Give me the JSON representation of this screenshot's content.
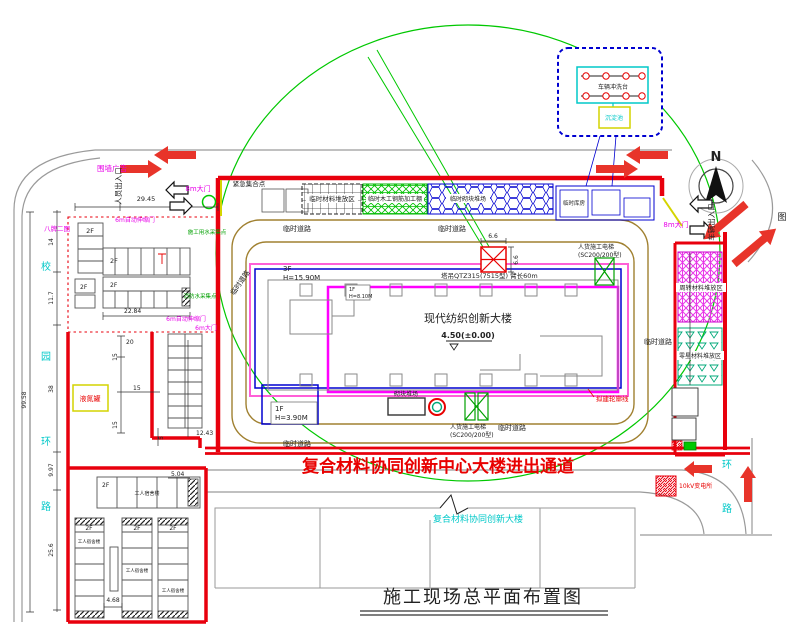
{
  "title": "施工现场总平面布置图",
  "passage_text": "复合材料协同创新中心大楼进出通道",
  "existing_building": "复合材料协同创新大楼",
  "compass": {
    "north": "N"
  },
  "legend_char": "图",
  "building": {
    "name": "现代纺织创新大楼",
    "elevation": "4.50(±0.00)",
    "f3": "3F",
    "h3": "H=15.90M",
    "f1": "1F",
    "h1": "H=3.90M",
    "fa": "1F",
    "ha": "H=8.10M",
    "f2": "2F"
  },
  "equipment": {
    "tower_crane": "塔吊QTZ315(7515型) 臂长60m",
    "hoist_line1": "人货施工电梯",
    "hoist_line2": "(SC200/200型)"
  },
  "gates": {
    "gate8m": "8m大门",
    "gate6m": "6m大门",
    "auto_gate": "6m自动伸缩门",
    "people_entrance": "人员出入口",
    "vehicle_entrance": "车辆出入口"
  },
  "facilities": {
    "fence_ad": "围墙广告",
    "eight_boards": "八牌二图",
    "emergency": "紧急集合点",
    "water_collect": "施工用水采集点",
    "fire_water": "消防水采集点",
    "temp_road": "临时道路",
    "material_area": "临时材料堆放区",
    "wood_shed": "临时木工钢筋加工棚",
    "block_yard_top": "临时砌块堆场",
    "storehouse": "临时库房",
    "wash_platform": "车辆冲洗台",
    "sediment": "沉淀池",
    "turnover_area": "周转材料堆放区",
    "misc_area": "零星材料堆放区",
    "outline_label": "拟建轮廓线",
    "block_yard": "砌块堆场",
    "nitrogen": "液氮罐",
    "dorm": "工人宿舍楼",
    "substation": "10kV变电所"
  },
  "roads": {
    "xiao": "校",
    "yuan": "园",
    "huan": "环",
    "lu": "路"
  },
  "dims": {
    "d2945": "29.45",
    "d2284": "22.84",
    "d9958": "99.58",
    "d14": "14",
    "d117": "11.7",
    "d38": "38",
    "d997": "9.97",
    "d256": "25.6",
    "d20": "20",
    "d15": "15",
    "d5": "5",
    "d1243": "12.43",
    "d504": "5.04",
    "d468": "4.68",
    "d66": "6.6"
  }
}
